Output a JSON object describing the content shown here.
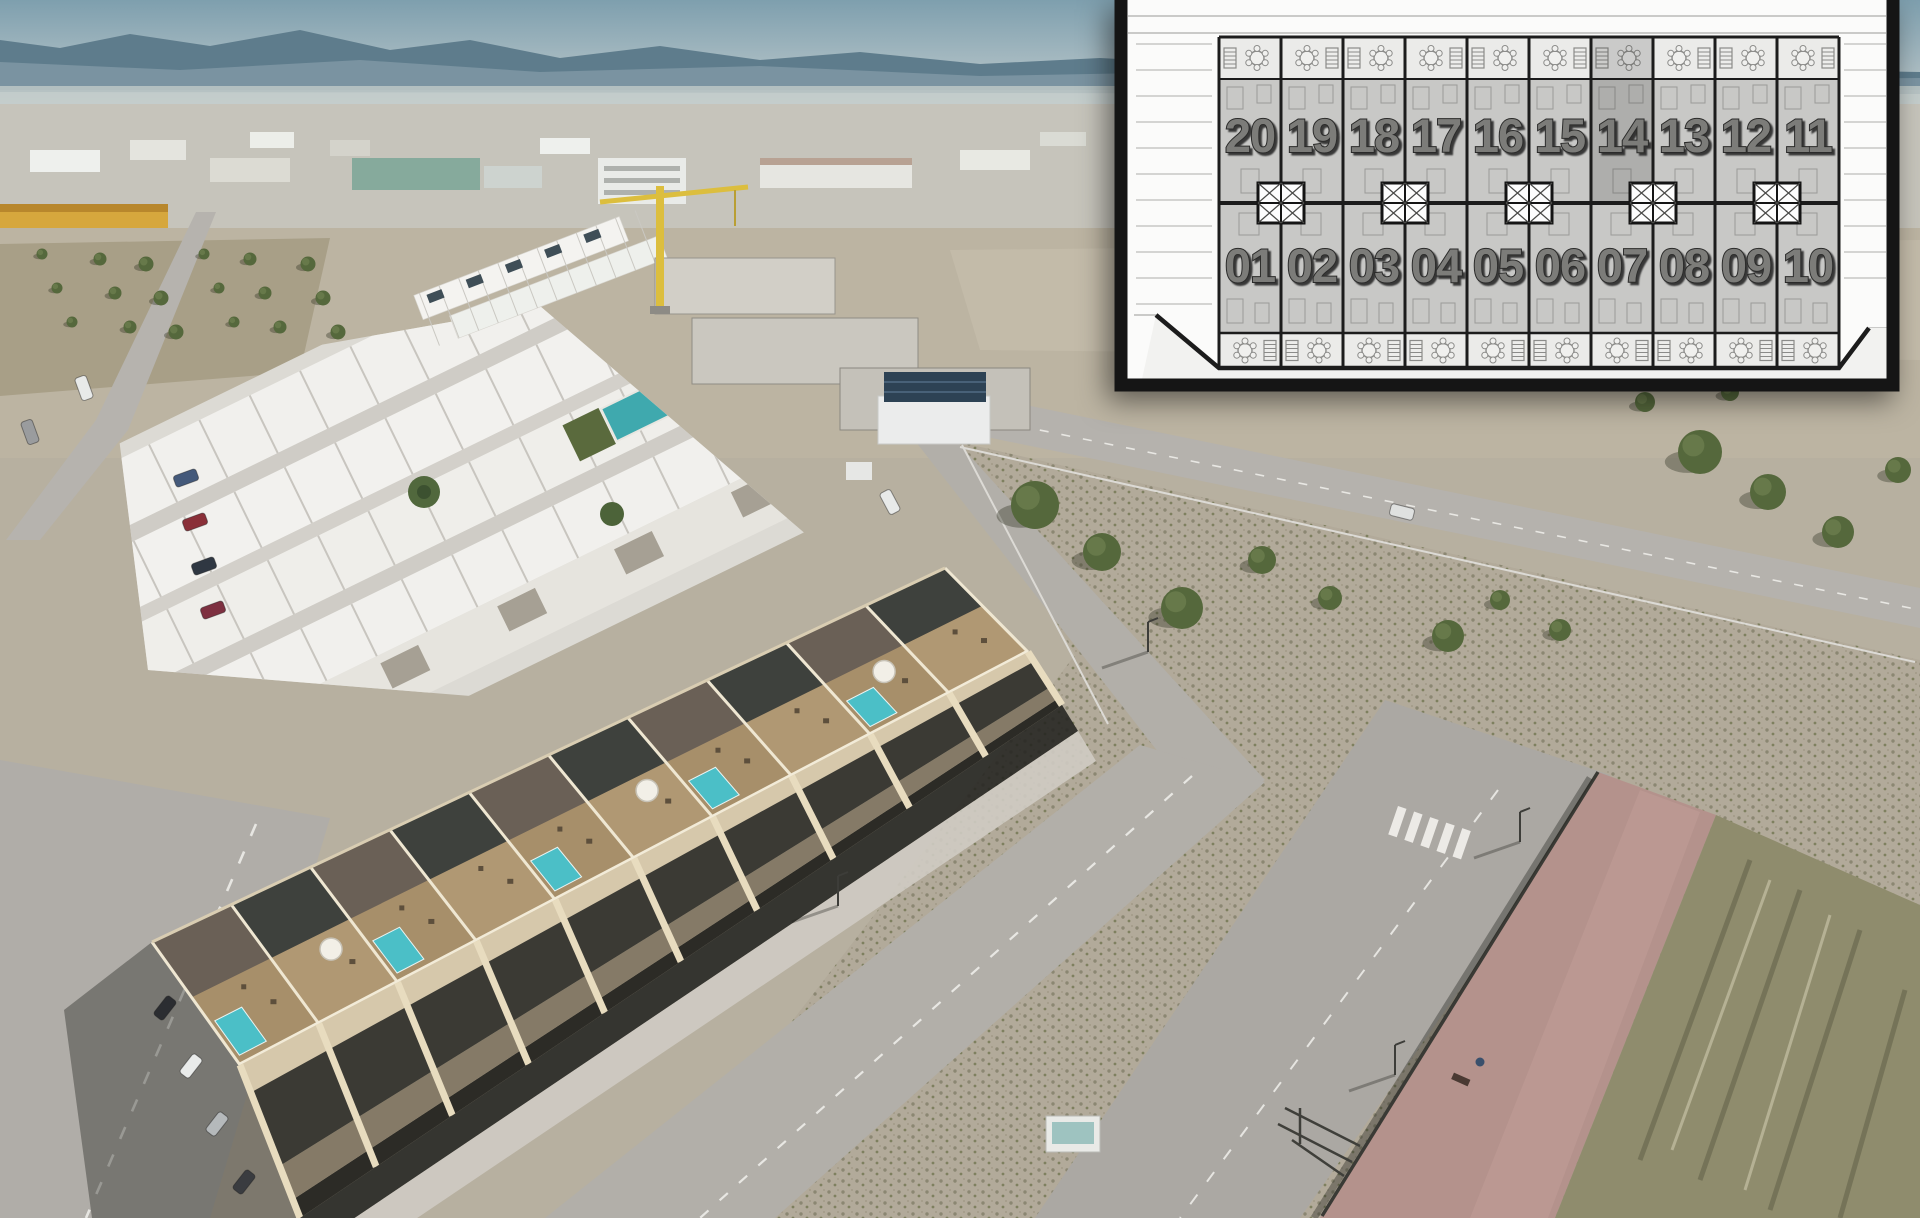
{
  "site_plan_inset": {
    "units_top_row": [
      "20",
      "19",
      "18",
      "17",
      "16",
      "15",
      "14",
      "13",
      "12",
      "11"
    ],
    "units_bottom_row": [
      "01",
      "02",
      "03",
      "04",
      "05",
      "06",
      "07",
      "08",
      "09",
      "10"
    ],
    "highlighted_unit": "14",
    "rows": 2,
    "units_per_row": 10,
    "icons": {
      "terrace_table": "round-table-with-chairs",
      "stairs": "staircase-hatch",
      "stairwell_box": "crossed-shaft-box"
    },
    "colors": {
      "frame": "#151515",
      "panel": "#fbfbfa",
      "terrace_fill": "#ebebe9",
      "unit_fill": "#c8c8c6",
      "plan_line": "#1c1c1c",
      "detail_line": "#9a9a98",
      "number_fill": "#7b7b79",
      "number_outline": "#2c2c2a",
      "highlight_overlay": "rgba(55,55,53,0.18)"
    }
  },
  "photo": {
    "colors": {
      "sky": "#7e9fae",
      "mountains": "#5e7c8c",
      "haze": "#c6cecb",
      "town_band": "#c6c4bb",
      "yellow_building": "#d6a73d",
      "warehouse_teal_roof": "#86aa9c",
      "field": "#bcb4a2",
      "dirt_lot": "#b2aa9a",
      "road": "#b5b2ad",
      "lane_marking": "#e8e7e3",
      "existing_roofs": "#f1f0ed",
      "communal_pool": "#3fa9ae",
      "hedge": "#5a6a3d",
      "crane": "#dcbe3e",
      "new_building_walls": "#d6c8ab",
      "roof_deck": "#ac946e",
      "pergola": "#3e413d",
      "plunge_pool": "#4bbfc7",
      "window_band": "#3b3a34",
      "building_shadow": "rgba(38,37,32,0.40)",
      "pink_walkway": "#b4928c",
      "grass_verge": "#8f8c6d",
      "tree": "#55683c"
    }
  }
}
